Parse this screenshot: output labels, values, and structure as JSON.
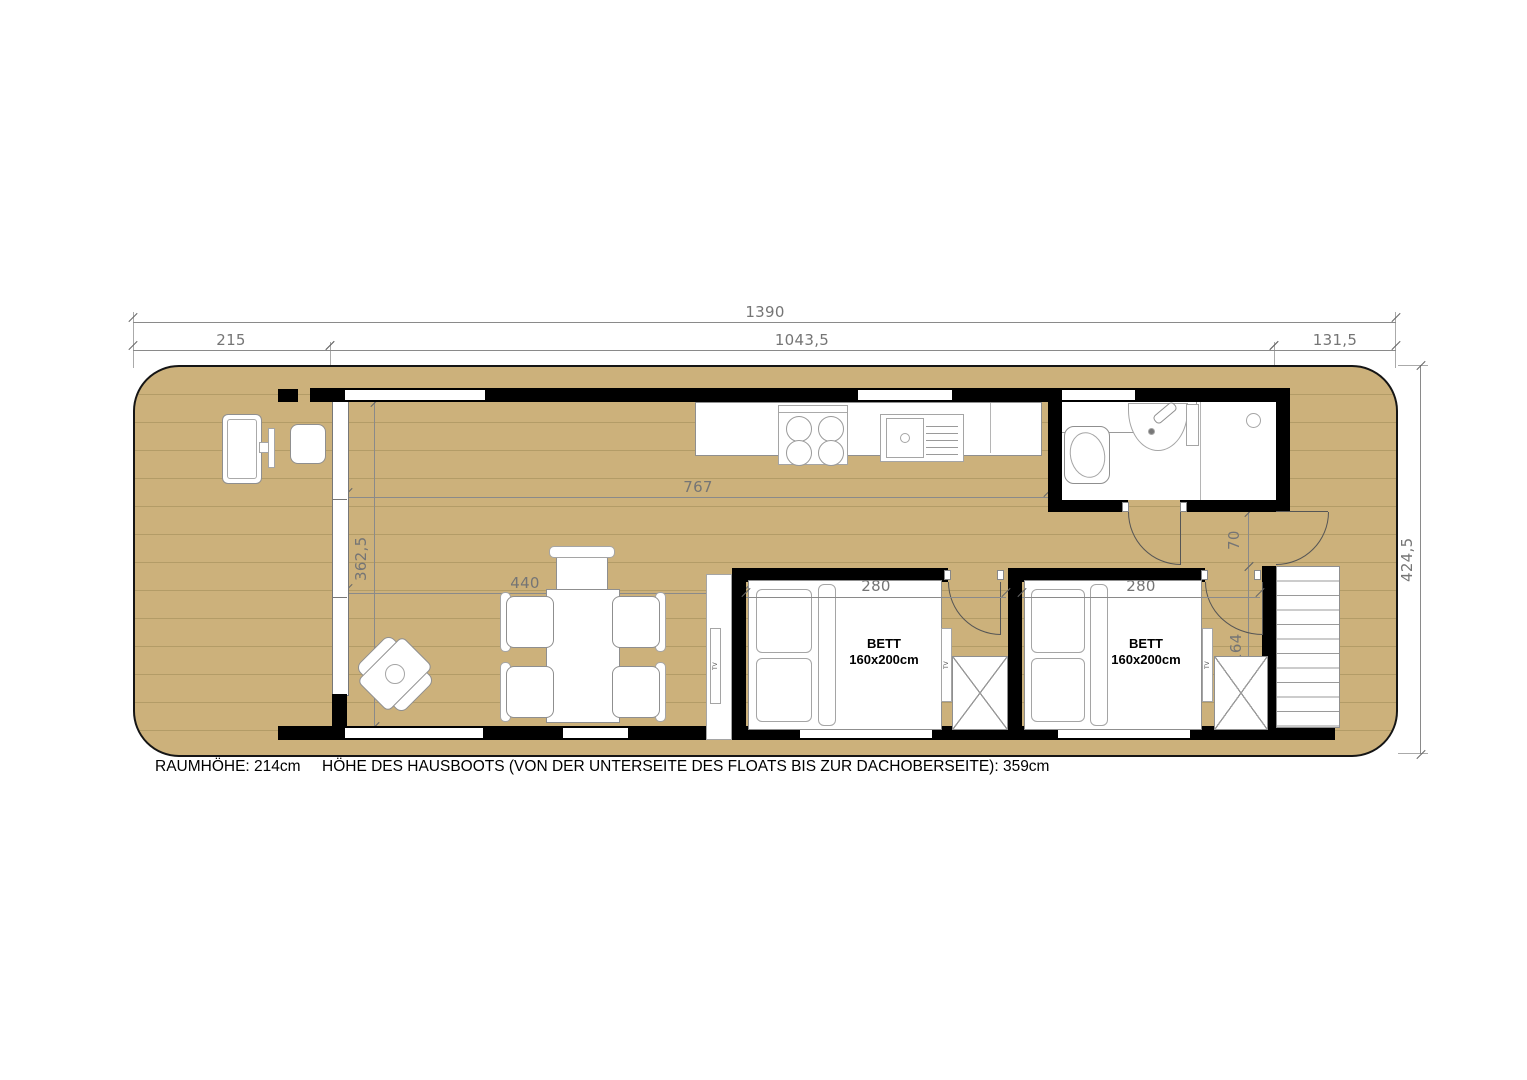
{
  "colors": {
    "deck": "#ccb17b",
    "plank_line": "#b39c67",
    "wall": "#000000",
    "fixture_outline": "#8f8f8f",
    "dimension": "#757575"
  },
  "top_dims": {
    "overall": "1390",
    "front_deck": "215",
    "cabin": "1043,5",
    "rear_deck": "131,5"
  },
  "side_dims": {
    "overall_width": "424,5"
  },
  "interior_dims": {
    "living_width": "767",
    "glass_front_height": "362,5",
    "living_length": "440",
    "bed1_width": "280",
    "bed2_width": "280",
    "bath_width": "230",
    "bath_depth": "114,5",
    "hall_width": "70",
    "nook_depth": "164"
  },
  "labels": {
    "bed_line1": "BETT",
    "bed_line2": "160x200cm",
    "tv": "TV"
  },
  "fixtures": [
    "stove-icon",
    "sink-icon",
    "washbasin-icon",
    "toilet-icon",
    "shower-drain-icon",
    "bed",
    "pillow",
    "wardrobe-icon",
    "tv-icon",
    "dining-table",
    "chair",
    "lounge-chair",
    "stairs",
    "deck-tv",
    "deck-side-table",
    "door-swing",
    "sliding-glass-wall"
  ],
  "footer": {
    "room_height": "RAUMHÖHE: 214cm",
    "boat_height": "HÖHE DES HAUSBOOTS (VON DER UNTERSEITE DES FLOATS BIS ZUR DACHOBERSEITE): 359cm"
  }
}
